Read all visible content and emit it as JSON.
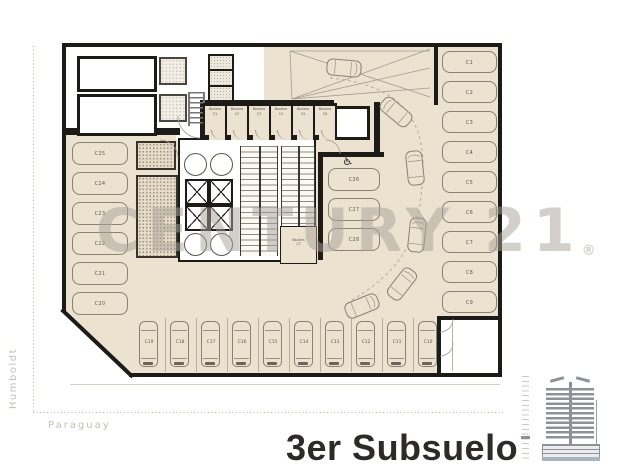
{
  "title": "3er Subsuelo",
  "watermark": {
    "text": "CENTURY 21",
    "registered_mark": "®"
  },
  "streets": {
    "left_street": "Humboldt",
    "bottom_street": "Paraguay"
  },
  "accessible_icon": "♿",
  "parking": {
    "left_column": [
      "C25",
      "C24",
      "C23",
      "C22",
      "C21",
      "C20"
    ],
    "center_column": [
      "C26",
      "C27",
      "C28"
    ],
    "right_column": [
      "C1",
      "C2",
      "C3",
      "C4",
      "C5",
      "C6",
      "C7",
      "C8",
      "C9"
    ],
    "bottom_row": [
      "C19",
      "C18",
      "C17",
      "C16",
      "C15",
      "C14",
      "C13",
      "C12",
      "C11",
      "C10"
    ]
  },
  "storage_units": {
    "row": [
      {
        "type": "Baulera",
        "code": "C1"
      },
      {
        "type": "Baulera",
        "code": "C2"
      },
      {
        "type": "Baulera",
        "code": "C3"
      },
      {
        "type": "Baulera",
        "code": "C4"
      },
      {
        "type": "Baulera",
        "code": "C5"
      },
      {
        "type": "Baulera",
        "code": "C6"
      }
    ],
    "core_unit": {
      "type": "Baulera",
      "code": "C7"
    }
  },
  "colors": {
    "floor": "#ebe2d0",
    "wall": "#1d1b18",
    "line": "#8a8174",
    "watermark": "#aaa49a",
    "title": "#2c2b29",
    "street_label": "#c5c0b5",
    "building_icon": "#8d9299",
    "building_base": "#a9b6c0"
  }
}
